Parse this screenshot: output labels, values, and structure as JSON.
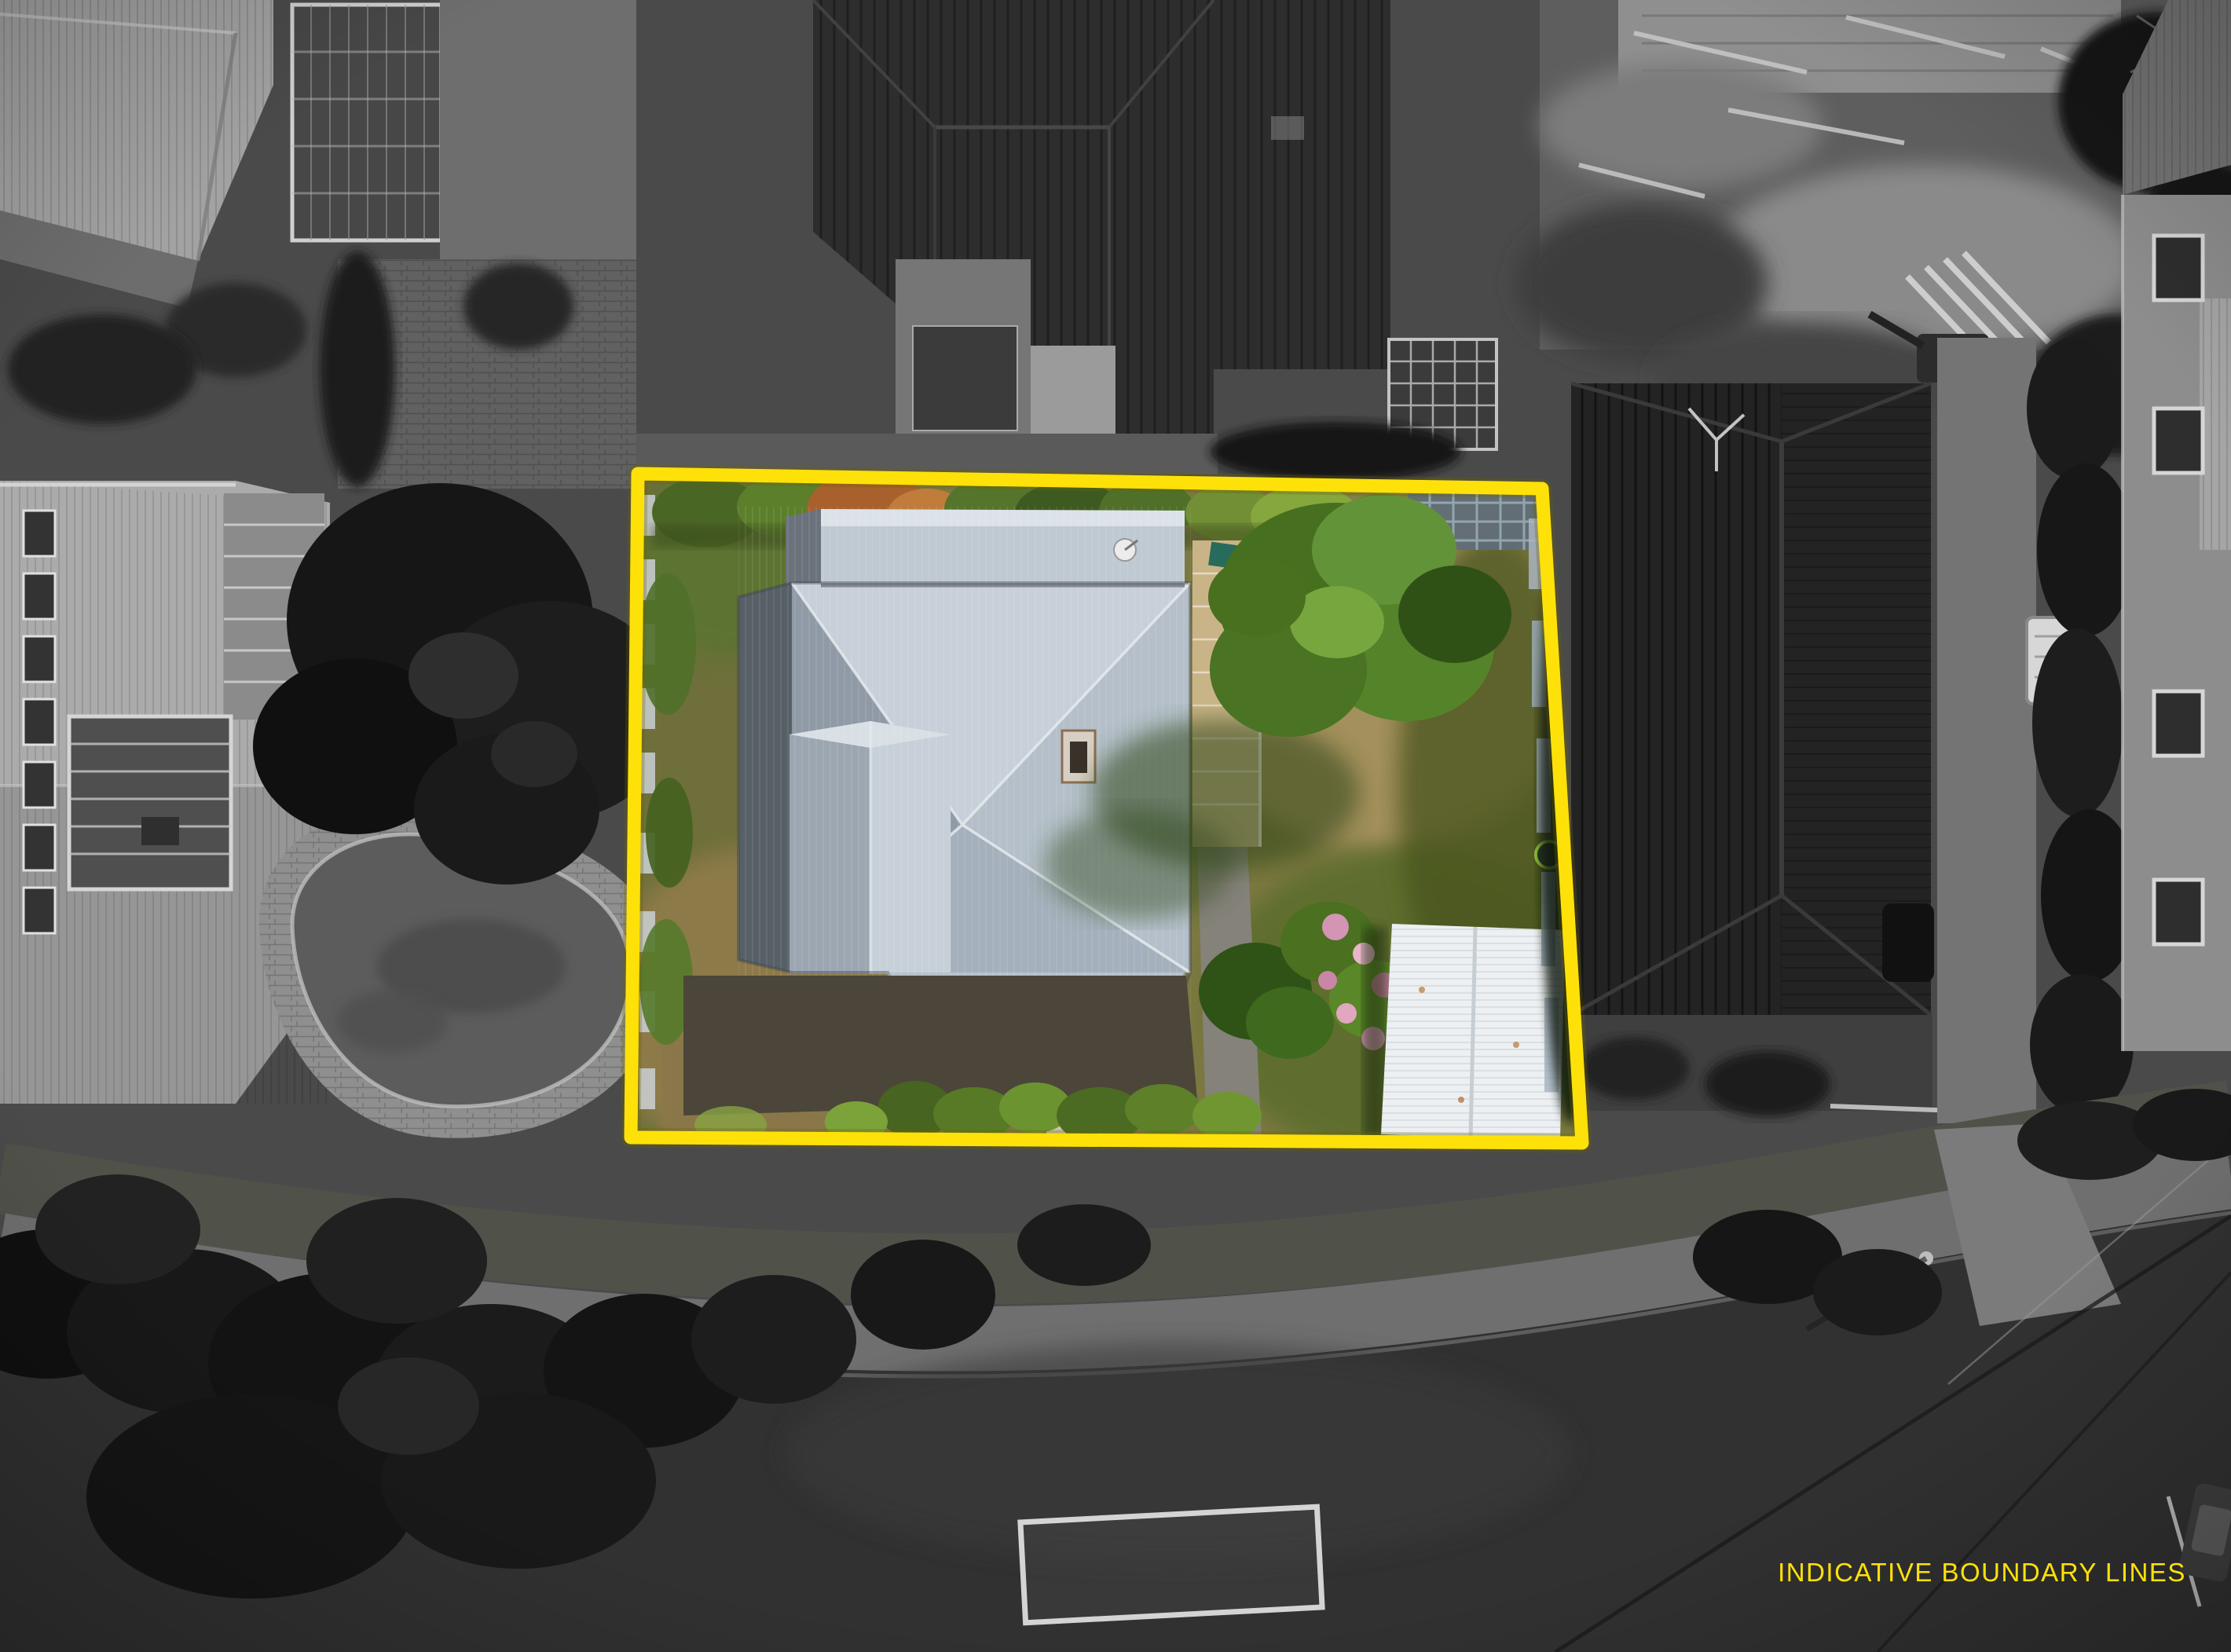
{
  "overlay": {
    "caption": "INDICATIVE BOUNDARY LINES",
    "caption_color": "#FFE10A",
    "boundary_color": "#FFE10A"
  },
  "palette": {
    "asphalt": "#313131",
    "footpath_concrete": "#6f6f6f",
    "lawn_olive": "#7b7841",
    "lawn_green": "#5d7330",
    "lawn_dry": "#a3905c",
    "villa_roof_light": "#c7d0d9",
    "villa_roof_shaded": "#575f67",
    "shed_roof_white": "#edf0f2",
    "neighbor_roof_dark": "#232323",
    "tree_green": "#46701f",
    "hydrangea_pink": "#d494b4"
  }
}
